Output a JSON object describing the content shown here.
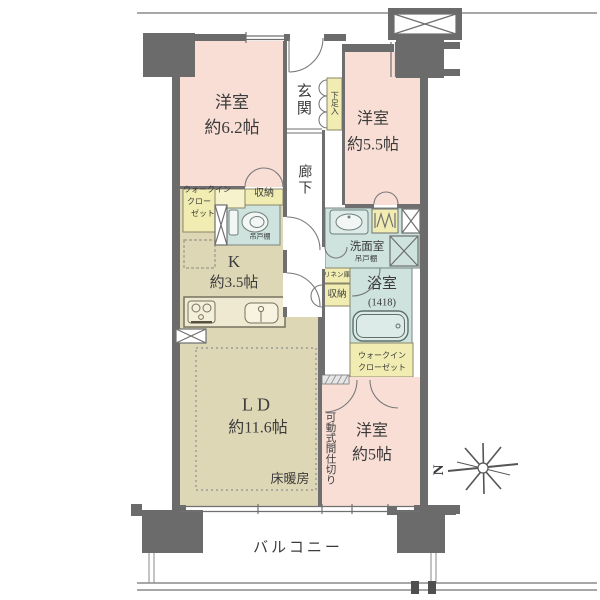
{
  "labels": {
    "bedroom1_name": "洋室",
    "bedroom1_size": "約6.2帖",
    "entrance": "玄関",
    "shoe_box": "下足入",
    "bedroom2_name": "洋室",
    "bedroom2_size": "約5.5帖",
    "corridor": "廊下",
    "wic1_l1": "ウォークイン",
    "wic1_l2": "クロー",
    "wic1_l3": "ゼット",
    "storage1": "収納",
    "toilet_shelf": "吊戸棚",
    "kitchen_name": "K",
    "kitchen_size": "約3.5帖",
    "washroom": "洗面室",
    "washroom_shelf": "吊戸棚",
    "linen": "リネン庫",
    "storage2": "収納",
    "bath_name": "浴室",
    "bath_size": "(1418)",
    "wic2_l1": "ウォークイン",
    "wic2_l2": "クローゼット",
    "living_name": "LD",
    "living_size": "約11.6帖",
    "floor_heating": "床暖房",
    "partition": "可動式間仕切り",
    "bedroom3_name": "洋室",
    "bedroom3_size": "約5帖",
    "balcony": "バルコニー",
    "compass_letter": "N"
  },
  "colors": {
    "room_pink": "#f8ded5",
    "kitchen_beige": "#ddd7b6",
    "storage_yellow": "#f1edb2",
    "wet_area_teal": "#cee3de",
    "wall_gray": "#6b6b6b"
  }
}
